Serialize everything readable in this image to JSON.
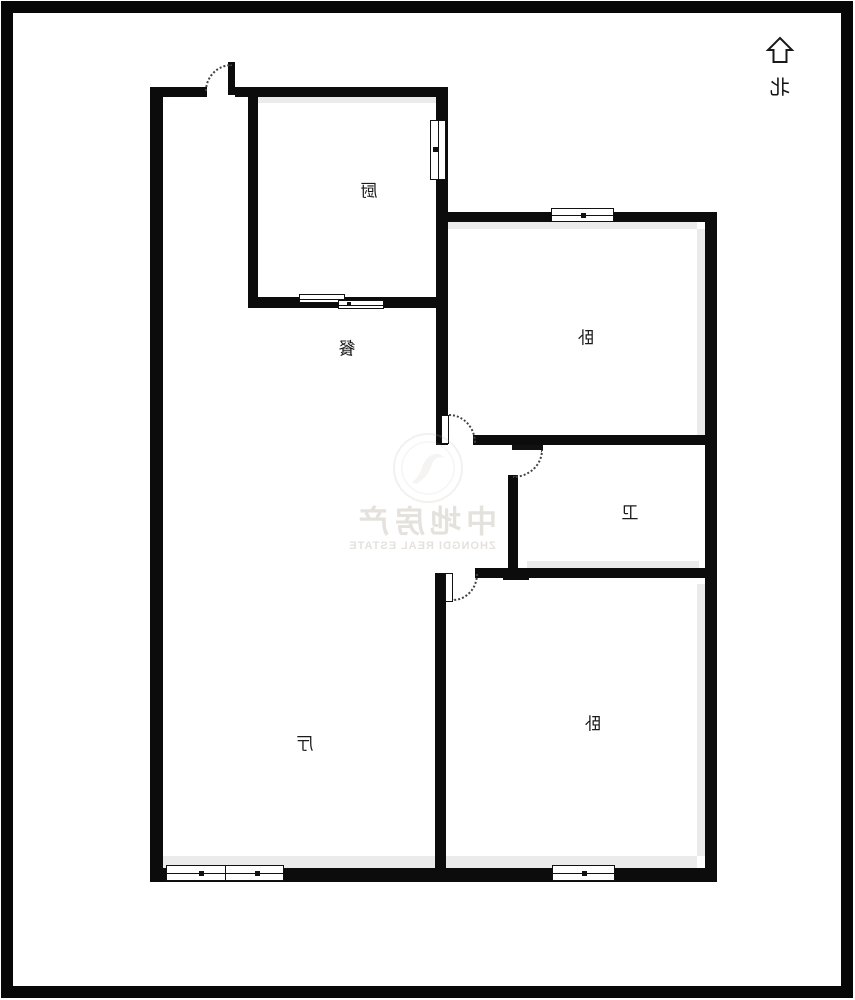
{
  "title": "户型图",
  "compass": {
    "label": "北",
    "icon": "north-up-arrow"
  },
  "rooms": {
    "kitchen": {
      "label": "厨"
    },
    "dining": {
      "label": "餐"
    },
    "bedroom_top": {
      "label": "卧"
    },
    "bathroom": {
      "label": "卫"
    },
    "bedroom_bottom": {
      "label": "卧"
    },
    "living": {
      "label": "厅"
    }
  },
  "watermark": {
    "cn": "中地房产",
    "en": "ZHONGDI REAL ESTATE"
  },
  "colors": {
    "wall": "#0c0c0c",
    "shadow": "#ebebeb",
    "watermark": "rgba(186,178,166,0.38)"
  },
  "icons": {
    "north_arrow": "hollow-up-arrow",
    "emblem": "faint-circular-seal"
  }
}
